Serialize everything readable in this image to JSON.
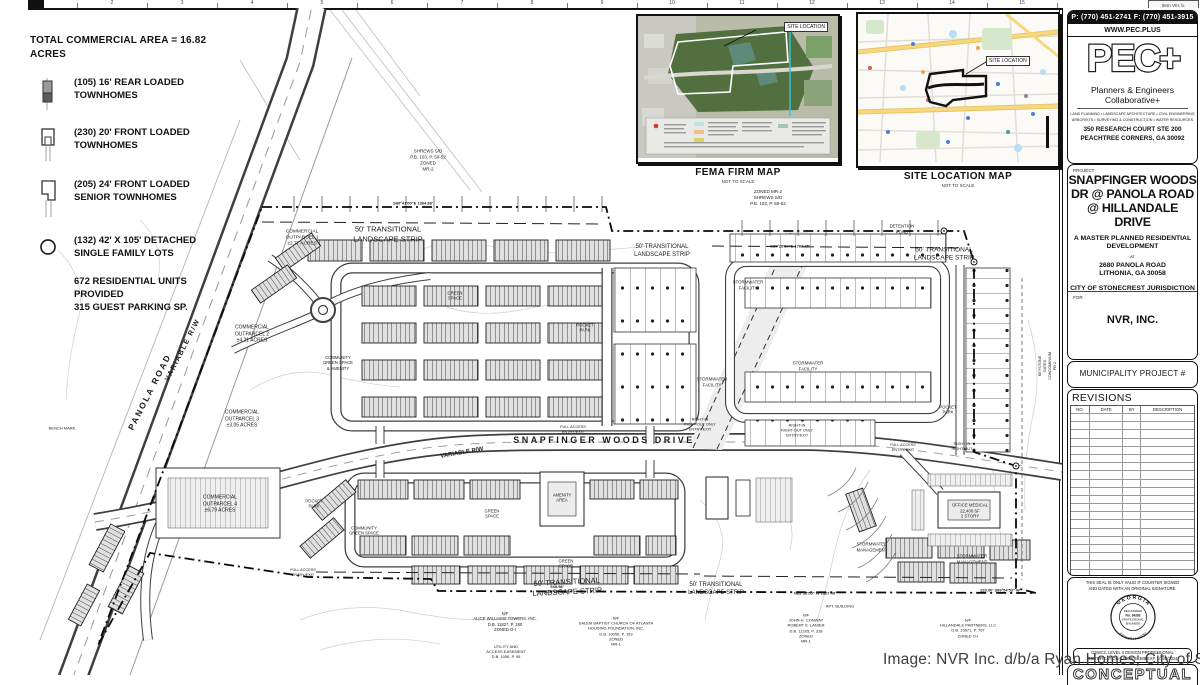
{
  "sheet": {
    "item_ref": "Item VIII. b.",
    "ruler_numbers": [
      "1",
      "2",
      "3",
      "4",
      "5",
      "6",
      "7",
      "8",
      "9",
      "10",
      "11",
      "12",
      "13",
      "14",
      "15"
    ],
    "watermark": "Image: NVR Inc. d/b/a Ryan Homes; City of Stonecrest",
    "conceptual_label": "CONCEPTUAL"
  },
  "legend": {
    "title": "TOTAL COMMERCIAL AREA = 16.82\nACRES",
    "items": [
      {
        "icon": "rear-loaded-townhome-icon",
        "label": "(105) 16' REAR LOADED\nTOWNHOMES"
      },
      {
        "icon": "front-loaded-townhome-icon",
        "label": "(230) 20' FRONT LOADED\nTOWNHOMES"
      },
      {
        "icon": "senior-townhome-icon",
        "label": "(205) 24' FRONT LOADED\nSENIOR TOWNHOMES"
      },
      {
        "icon": "detached-lot-icon",
        "label": "(132) 42' X 105' DETACHED\nSINGLE FAMILY LOTS"
      }
    ],
    "summary": "672 RESIDENTIAL UNITS\nPROVIDED\n315 GUEST PARKING SP."
  },
  "insets": {
    "fema": {
      "title": "FEMA FIRM MAP",
      "subtitle": "NOT TO SCALE",
      "site_label": "SITE LOCATION"
    },
    "site": {
      "title": "SITE LOCATION MAP",
      "subtitle": "NOT TO SCALE",
      "site_label": "SITE LOCATION"
    }
  },
  "titleblock": {
    "phone": "P: (770) 451-2741   F: (770) 451-3915",
    "website": "WWW.PEC.PLUS",
    "logo": "PEC+",
    "firm": "Planners & Engineers Collaborative+",
    "services1": "LAND PLANNING • LANDSCAPE ARCHITECTURE • CIVIL ENGINEERING",
    "services2": "ARBORISTS • SURVEYING & CONSTRUCTION • WATER RESOURCES",
    "address1": "350 RESEARCH COURT  STE 200",
    "address2": "PEACHTREE CORNERS, GA 30092",
    "project_label": "PROJECT",
    "project_title": "SNAPFINGER WOODS\nDR @ PANOLA ROAD\n@ HILLANDALE DRIVE",
    "project_sub1": "A MASTER PLANNED RESIDENTIAL\nDEVELOPMENT",
    "project_at": "AT",
    "project_addr1": "2680 PANOLA ROAD",
    "project_addr2": "LITHONIA, GA 30058",
    "jurisdiction": "CITY OF STONECREST JURISDICTION",
    "for_label": "FOR",
    "client": "NVR, INC.",
    "municipality": "MUNICIPALITY PROJECT #",
    "revisions_title": "REVISIONS",
    "revisions_headers": [
      "NO.",
      "DATE",
      "BY",
      "DESCRIPTION"
    ],
    "seal_note": "THIS SEAL IS ONLY VALID IF COUNTER SIGNED\nAND DATED WITH AN ORIGINAL SIGNATURE.",
    "seal_state": "G E O R G I A",
    "seal_registered": "REGISTERED",
    "seal_no": "No. 34393",
    "seal_prof": "PROFESSIONAL",
    "seal_eng": "ENGINEER",
    "seal_name": "KENNETH J WOOD",
    "gswcc": "GSWCC LEVEL II DESIGN PROFESSIONAL\nCERTIFICATION # 0000059389 EXP. 10/28/2024"
  },
  "plan": {
    "labels": [
      {
        "id": "shrews-sd-nw",
        "text": "SHREWS S/D\nP.B. 103, P. 50-52\nZONED\nMR-2",
        "x": 428,
        "y": 160,
        "fs": 4.5
      },
      {
        "id": "shrews-sd-ne",
        "text": "ZONED MR-2\nSHREWS S/D\nP.B. 103, P. 50-52",
        "x": 768,
        "y": 198,
        "fs": 4.5
      },
      {
        "id": "landscape-strip-nw",
        "text": "50' TRANSITIONAL\nLANDSCAPE STRIP",
        "x": 388,
        "y": 234,
        "fs": 7.5
      },
      {
        "id": "landscape-strip-n2",
        "text": "50' TRANSITIONAL\nLANDSCAPE STRIP",
        "x": 662,
        "y": 252,
        "fs": 6
      },
      {
        "id": "landscape-strip-ne",
        "text": "50' TRANSITIONAL\nLANDSCAPE STRIP",
        "x": 944,
        "y": 255,
        "fs": 6.5
      },
      {
        "id": "landscape-strip-s1",
        "text": "50' TRANSITIONAL\nLANDSCAPE STRIP",
        "x": 567,
        "y": 587,
        "rot": -3,
        "fs": 7.5
      },
      {
        "id": "landscape-strip-s2",
        "text": "50' TRANSITIONAL\nLANDSCAPE STRIP",
        "x": 716,
        "y": 590,
        "fs": 6
      },
      {
        "id": "detention-pond",
        "text": "DETENTION\nPOND",
        "x": 902,
        "y": 229,
        "fs": 4.3
      },
      {
        "id": "outparcel-1",
        "text": "COMMERCIAL\nOUTPARCEL 1\n±2.77 ACRES",
        "x": 302,
        "y": 239,
        "fs": 4.8
      },
      {
        "id": "outparcel-2",
        "text": "COMMERCIAL\nOUTPARCEL 2\n±4.21 ACRES",
        "x": 252,
        "y": 334,
        "fs": 5
      },
      {
        "id": "outparcel-3",
        "text": "COMMERCIAL\nOUTPARCEL 3\n±3.05 ACRES",
        "x": 242,
        "y": 419,
        "fs": 5
      },
      {
        "id": "outparcel-4",
        "text": "COMMERCIAL\nOUTPARCEL 4\n±6.79 ACRES",
        "x": 220,
        "y": 504,
        "fs": 5
      },
      {
        "id": "panola-road",
        "text": "PANOLA ROAD",
        "x": 150,
        "y": 392,
        "rot": -63,
        "fs": 8.5,
        "fw": 700,
        "ls": 2
      },
      {
        "id": "panola-variable-rw",
        "text": "VARIABLE R/W",
        "x": 183,
        "y": 350,
        "rot": -63,
        "fs": 7,
        "fw": 700,
        "ls": 1.5
      },
      {
        "id": "snapfinger-woods-drive",
        "text": "SNAPFINGER WOODS DRIVE",
        "x": 604,
        "y": 441,
        "fs": 9,
        "fw": 700,
        "ls": 2.5
      },
      {
        "id": "swd-variable-rw",
        "text": "VARIABLE R/W",
        "x": 462,
        "y": 454,
        "rot": -10,
        "fs": 6,
        "fw": 700
      },
      {
        "id": "stormwater-facility-1",
        "text": "STORMWATER\nFACILITY",
        "x": 748,
        "y": 285,
        "fs": 4.3
      },
      {
        "id": "stormwater-facility-2",
        "text": "STORMWATER\nFACILITY",
        "x": 712,
        "y": 382,
        "fs": 4.3
      },
      {
        "id": "stormwater-facility-3",
        "text": "STORMWATER\nFACILITY",
        "x": 808,
        "y": 366,
        "fs": 4.3
      },
      {
        "id": "stormwater-mgmt-1",
        "text": "STORMWATER\nMANAGEMENT",
        "x": 872,
        "y": 547,
        "fs": 4.3
      },
      {
        "id": "stormwater-mgmt-2",
        "text": "STORMWATER\nMANAGEMENT",
        "x": 972,
        "y": 559,
        "fs": 4.3
      },
      {
        "id": "office-medical",
        "text": "OFFICE MEDICAL\n22,400 SF\n2 STORY",
        "x": 970,
        "y": 511,
        "fs": 4.3
      },
      {
        "id": "pocket-park-w",
        "text": "POCKET\nPARK",
        "x": 314,
        "y": 504,
        "fs": 4.2
      },
      {
        "id": "pocket-park-n",
        "text": "POCKET\nPARK",
        "x": 585,
        "y": 328,
        "fs": 4.2
      },
      {
        "id": "pocket-park-e",
        "text": "POCKET\nPARK",
        "x": 948,
        "y": 410,
        "fs": 4.2
      },
      {
        "id": "community-green-amenity",
        "text": "COMMUNITY\nGREEN SPACE\n& AMENITY",
        "x": 338,
        "y": 363,
        "fs": 4.2
      },
      {
        "id": "community-green",
        "text": "COMMUNITY\nGREEN SPACE",
        "x": 364,
        "y": 531,
        "fs": 4.2
      },
      {
        "id": "amenity-area",
        "text": "AMENITY\nAREA",
        "x": 562,
        "y": 498,
        "fs": 4.2
      },
      {
        "id": "green-space-1",
        "text": "GREEN\nSPACE",
        "x": 492,
        "y": 514,
        "fs": 4.2
      },
      {
        "id": "green-space-2",
        "text": "GREEN\nSPACE",
        "x": 566,
        "y": 564,
        "fs": 4.2
      },
      {
        "id": "green-space-3",
        "text": "GREEN\nSPACE",
        "x": 455,
        "y": 296,
        "fs": 4.2
      },
      {
        "id": "alice-williams",
        "text": "N/F\nALICE WILLIAMS TOWERS, INC.\nD.B. 11827, P. 260\nZONED O-I",
        "x": 505,
        "y": 622,
        "fs": 4.2
      },
      {
        "id": "utility-easement",
        "text": "UTILITY AND\nACCESS EASEMENT\nD.B. 1056, P. 95",
        "x": 506,
        "y": 652,
        "fs": 4
      },
      {
        "id": "salem-baptist",
        "text": "N/F\nSALEM BAPTIST CHURCH OF ATLANTA\nHOUSING FOUNDATION, INC.\nD.B. 10056, P. 153\nZONED\nMR-1",
        "x": 616,
        "y": 631,
        "fs": 4
      },
      {
        "id": "conway-lanier",
        "text": "N/F\nJOHN H. CONWAY\nROBERT E. LANIER\nD.B. 11205, P. 318\nZONED\nMR-1",
        "x": 806,
        "y": 628,
        "fs": 4
      },
      {
        "id": "apt-building",
        "text": "APT. BUILDING",
        "x": 840,
        "y": 606,
        "fs": 4
      },
      {
        "id": "hillandale-partners",
        "text": "N/F\nHILLANDALE PARTNERS, LLC\nD.B. 15671, P. 767\nZONED O-I",
        "x": 968,
        "y": 628,
        "fs": 4
      },
      {
        "id": "keystone-gates",
        "text": "KEYSTONE GATES CONDOMINIUM\nPB 2",
        "x": 1048,
        "y": 366,
        "rot": -90,
        "fs": 3.8
      },
      {
        "id": "full-access-1",
        "text": "FULL ACCESS\nENTRY/EXIT",
        "x": 573,
        "y": 430,
        "fs": 3.8
      },
      {
        "id": "full-access-2",
        "text": "FULL ACCESS\nENTRY/EXIT",
        "x": 303,
        "y": 573,
        "fs": 3.8
      },
      {
        "id": "full-access-3",
        "text": "FULL ACCESS\nENTRY/EXIT",
        "x": 903,
        "y": 448,
        "fs": 3.8
      },
      {
        "id": "right-in-out-1",
        "text": "RIGHT-IN\nRIGHT-OUT ONLY\nENTRY/EXIT",
        "x": 700,
        "y": 425,
        "fs": 3.8
      },
      {
        "id": "right-in-out-2",
        "text": "RIGHT-IN\nRIGHT-OUT ONLY\nENTRY/EXIT",
        "x": 797,
        "y": 431,
        "fs": 3.8
      },
      {
        "id": "right-in-out-3",
        "text": "RIGHT-IN\nRIGHT-OUT",
        "x": 962,
        "y": 447,
        "fs": 3.8
      },
      {
        "id": "bearing-north",
        "text": "S89°41'00\"E  1364.88'",
        "x": 413,
        "y": 203,
        "fs": 4,
        "fw": 700
      },
      {
        "id": "bearing-northeast",
        "text": "S89°28'57\"E  1768.85'",
        "x": 790,
        "y": 246,
        "fs": 4,
        "fw": 700
      },
      {
        "id": "bearing-south-1",
        "text": "668.98'\nS89°57'45\" E",
        "x": 557,
        "y": 589,
        "fs": 4,
        "fw": 700
      },
      {
        "id": "bearing-south-2",
        "text": "N89°58'55\" W  1327.49'",
        "x": 815,
        "y": 593,
        "fs": 4,
        "fw": 700
      },
      {
        "id": "bearing-south-3",
        "text": "220.00'  S89°54'53\" W",
        "x": 1000,
        "y": 590,
        "fs": 4,
        "fw": 700
      },
      {
        "id": "bench-mark",
        "text": "BENCH MARK",
        "x": 62,
        "y": 428,
        "fs": 4
      }
    ]
  }
}
